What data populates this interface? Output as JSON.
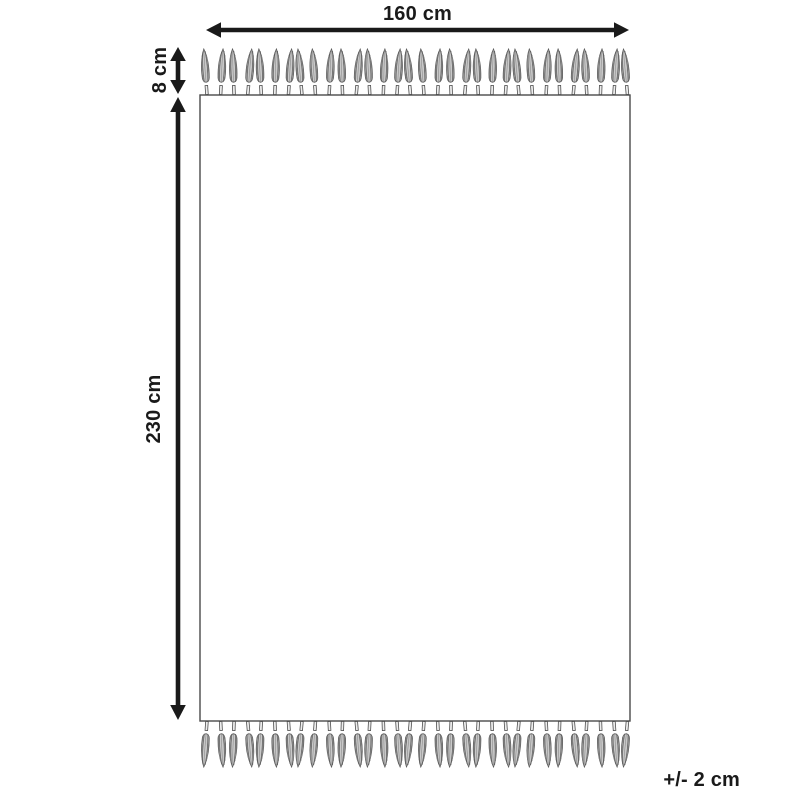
{
  "diagram": {
    "width_label": "160 cm",
    "fringe_label": "8 cm",
    "height_label": "230 cm",
    "tolerance_label": "+/- 2 cm",
    "fringe": {
      "top_count": 32,
      "bottom_count": 32
    },
    "colors": {
      "line": "#1a1a1a",
      "rug_outline": "#4a4a4a",
      "tassel_fill": "#c9c9c9",
      "tassel_stroke": "#5a5a5a"
    }
  }
}
